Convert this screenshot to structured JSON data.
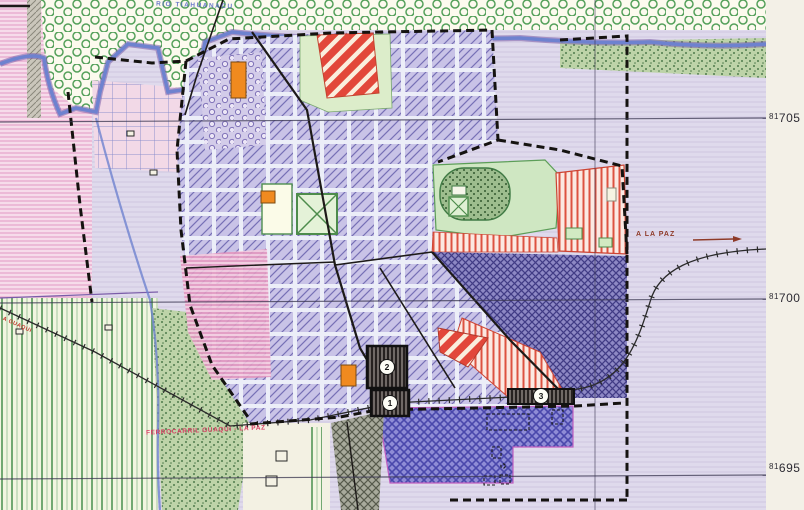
{
  "map": {
    "region_labels": {
      "river_top": "RIO TIAHUANACU",
      "to_la_paz": "A LA PAZ",
      "railway": "FERROCARRIL GUAQUI - LA PAZ",
      "to_guaqui": "A GUAQUI"
    },
    "grid_labels": [
      {
        "prefix": "81",
        "value": "705"
      },
      {
        "prefix": "81",
        "value": "700"
      },
      {
        "prefix": "81",
        "value": "695"
      }
    ],
    "markers": [
      {
        "number": "1"
      },
      {
        "number": "2"
      },
      {
        "number": "3"
      }
    ],
    "colors": {
      "urban_hatch": "#c9c3e7",
      "urban_line": "#7770b6",
      "red_zone": "#e2473a",
      "red_stripe_zone": "#dd5240",
      "park_green": "#cfe7c2",
      "orange_lot": "#f08a1f",
      "ruins_indigo": "#8f8cd6",
      "dense_zone": "#413c85",
      "fields_pink": "#f6dcea",
      "fields_green": "#f2f5e1",
      "river_blue": "#6e82cf",
      "paper_margin": "#f3f0e7"
    }
  }
}
